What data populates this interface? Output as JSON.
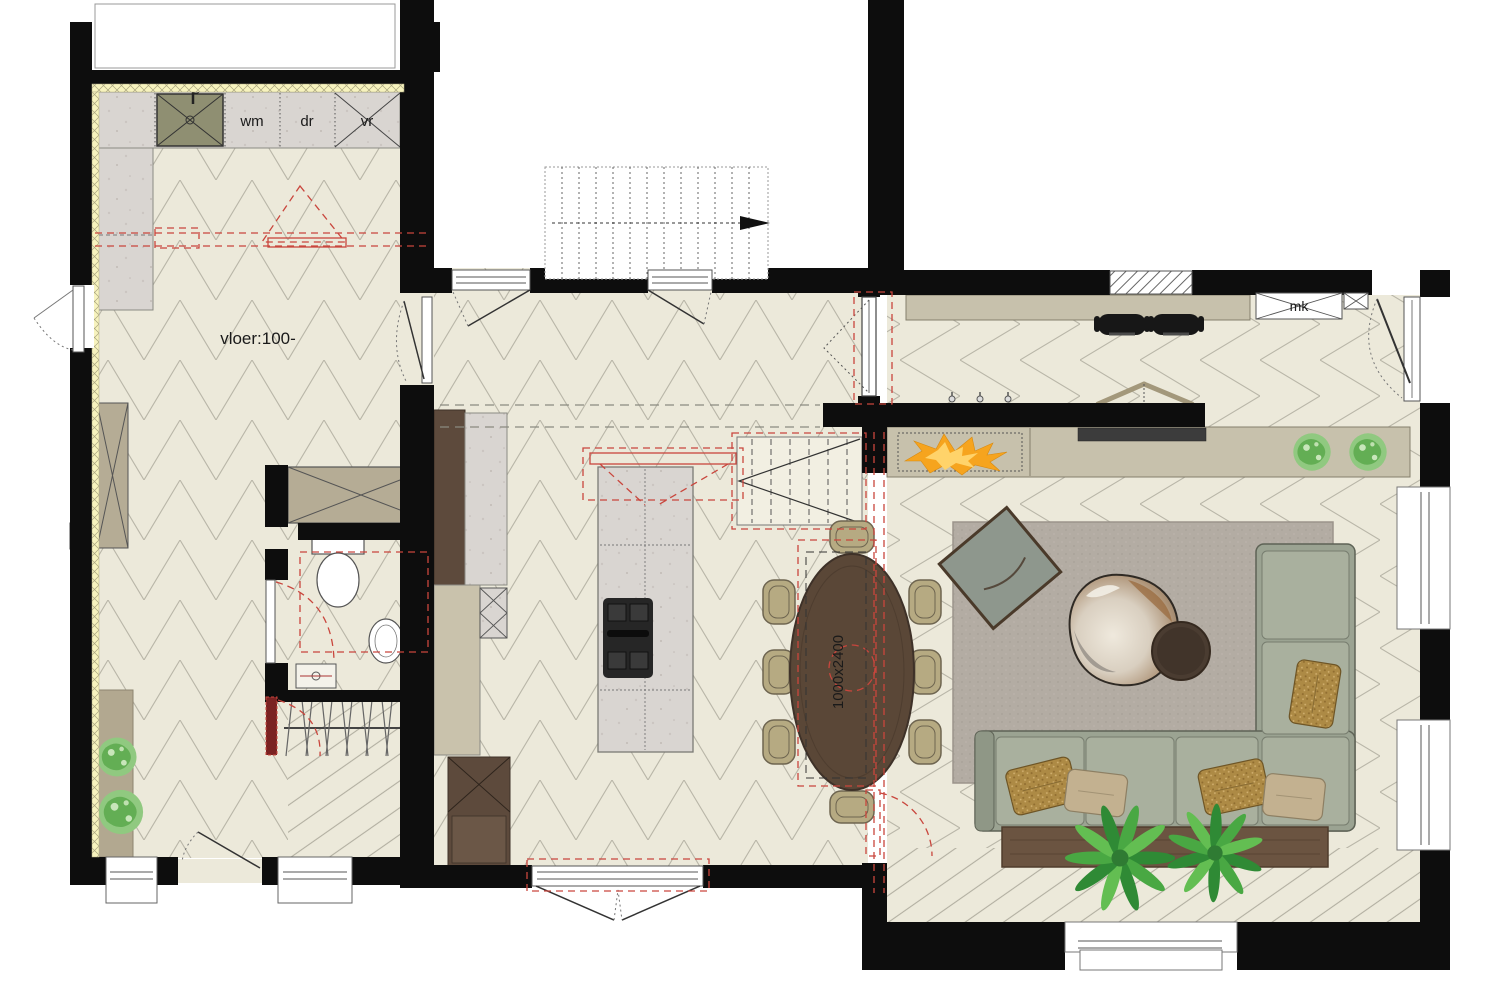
{
  "drawing": {
    "type": "architectural-floor-plan",
    "labels": {
      "washing_machine": "wm",
      "dryer": "dr",
      "freezer": "vr",
      "floor_level_note": "vloer:100-",
      "meter_cupboard": "mk",
      "dining_table_size": "1000x2400"
    },
    "palette": {
      "wall": "#0D0D0D",
      "floor": "#ECE9DA",
      "floor_line": "#B9B6A8",
      "insulation": "#F7F3BE",
      "counter_marble": "#D9D5D1",
      "cabinet_tan": "#B5AC95",
      "wood_dark": "#5D4A3C",
      "table_wood": "#5A4737",
      "chair_tan": "#B6AA82",
      "sofa_sage": "#9BA392",
      "rug_gray": "#B3ACA3",
      "annotation_red": "#C9463D",
      "flame_orange": "#F6A41E",
      "flame_yellow": "#FFD36A",
      "plant_green": "#5DA24E"
    }
  }
}
